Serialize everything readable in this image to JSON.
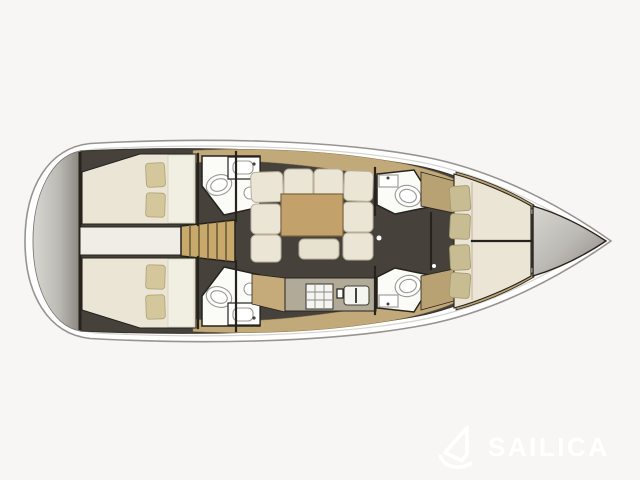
{
  "watermark": {
    "brand": "SAILICA",
    "icon": "sail-logo-icon"
  },
  "colors": {
    "background": "#f7f6f5",
    "hull_fill": "#ffffff",
    "hull_stroke": "#96948e",
    "deck_line": "#d5d3cd",
    "interior_floor": "#46423b",
    "wall_dark": "#26221d",
    "berth_cream": "#eae5d4",
    "berth_light": "#f1eee2",
    "pillow_khaki": "#d5c79c",
    "pillow_olive": "#c8bd92",
    "deck_wood": "#c2a97a",
    "cabinet_wood": "#b8a172",
    "table_wood": "#c2a26a",
    "steps_wood": "#c8a96c",
    "counter": "#b2aa98",
    "bath_floor": "#fbfbf8",
    "fixture_white": "#ffffff",
    "fixture_stroke": "#9a9892",
    "metal_light": "#d8d6d0",
    "metal_dark": "#88867f",
    "watermark": "#ffffff"
  },
  "floorplan": {
    "bow_direction": "right",
    "regions": [
      "stern-transom",
      "aft-cabin-port",
      "aft-cabin-starboard",
      "head-aft-port",
      "head-aft-starboard",
      "companionway-steps",
      "saloon-sofa",
      "saloon-table",
      "galley",
      "head-fwd-port",
      "head-fwd-starboard",
      "v-berth-cabin",
      "bow-locker"
    ]
  }
}
